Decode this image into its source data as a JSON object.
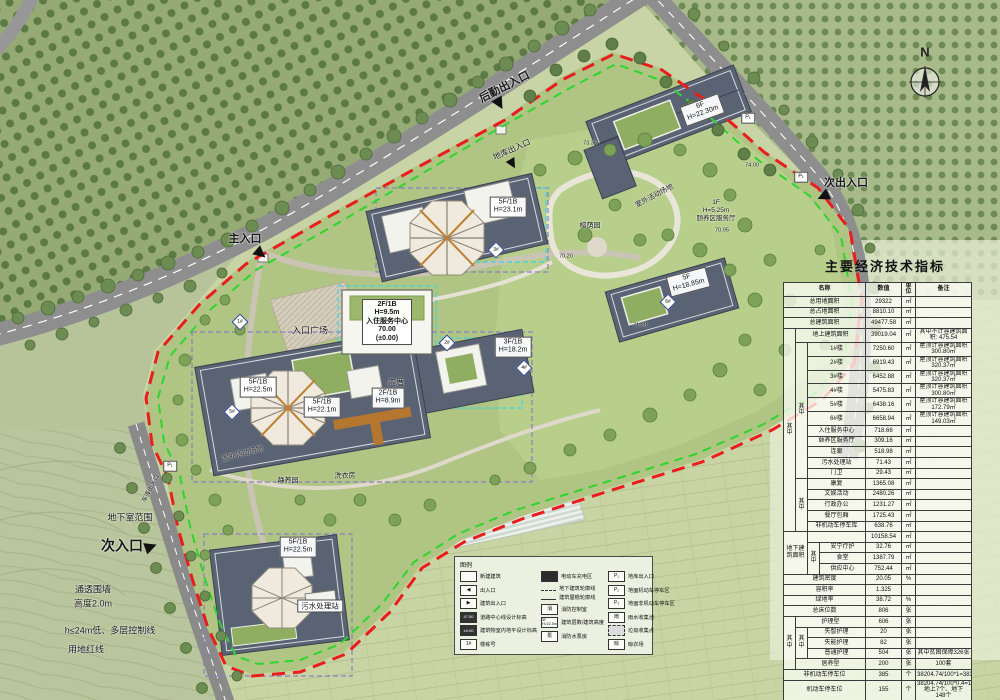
{
  "compass": {
    "label": "N"
  },
  "table": {
    "title": "主要经济技术指标",
    "col_widths": [
      12,
      12,
      12,
      46,
      36,
      14,
      56
    ],
    "rows": [
      [
        {
          "t": "名称",
          "cs": 4,
          "cls": "hd"
        },
        {
          "t": "数值",
          "cls": "hd"
        },
        {
          "t": "单位",
          "cls": "hd"
        },
        {
          "t": "备注",
          "cls": "hd"
        }
      ],
      [
        {
          "t": "总用地面积",
          "cs": 4
        },
        {
          "t": "29322"
        },
        {
          "t": "㎡"
        },
        {
          "t": ""
        }
      ],
      [
        {
          "t": "总占地面积",
          "cs": 4
        },
        {
          "t": "8810.10"
        },
        {
          "t": "㎡"
        },
        {
          "t": ""
        }
      ],
      [
        {
          "t": "总建筑面积",
          "cs": 4
        },
        {
          "t": "49477.58"
        },
        {
          "t": "㎡"
        },
        {
          "t": ""
        }
      ],
      [
        {
          "t": "其中",
          "rs": 17
        },
        {
          "t": "地上建筑面积",
          "cs": 3
        },
        {
          "t": "39019.04"
        },
        {
          "t": "㎡"
        },
        {
          "t": "其中不计容建筑面积: 475.54",
          "cls": "rem"
        }
      ],
      [
        {
          "t": "其中",
          "rs": 11
        },
        {
          "t": "1#楼",
          "cs": 2
        },
        {
          "t": "7250.60"
        },
        {
          "t": "㎡"
        },
        {
          "t": "屋顶计容建筑面积300.80㎡",
          "cls": "rem"
        }
      ],
      [
        {
          "t": "2#楼",
          "cs": 2
        },
        {
          "t": "6919.43"
        },
        {
          "t": "㎡"
        },
        {
          "t": "屋顶计容建筑面积320.37㎡",
          "cls": "rem"
        }
      ],
      [
        {
          "t": "3#楼",
          "cs": 2
        },
        {
          "t": "6452.88"
        },
        {
          "t": "㎡"
        },
        {
          "t": "屋顶计容建筑面积320.37㎡",
          "cls": "rem"
        }
      ],
      [
        {
          "t": "4#楼",
          "cs": 2
        },
        {
          "t": "5475.83"
        },
        {
          "t": "㎡"
        },
        {
          "t": "屋顶计容建筑面积300.80㎡",
          "cls": "rem"
        }
      ],
      [
        {
          "t": "5#楼",
          "cs": 2
        },
        {
          "t": "6438.16"
        },
        {
          "t": "㎡"
        },
        {
          "t": "屋顶计容建筑面积172.79㎡",
          "cls": "rem"
        }
      ],
      [
        {
          "t": "6#楼",
          "cs": 2
        },
        {
          "t": "6658.94"
        },
        {
          "t": "㎡"
        },
        {
          "t": "屋顶计容建筑面积149.03㎡",
          "cls": "rem"
        }
      ],
      [
        {
          "t": "入住服务中心",
          "cs": 2
        },
        {
          "t": "718.66"
        },
        {
          "t": "㎡"
        },
        {
          "t": ""
        }
      ],
      [
        {
          "t": "颐养区服务厅",
          "cs": 2
        },
        {
          "t": "309.16"
        },
        {
          "t": "㎡"
        },
        {
          "t": ""
        }
      ],
      [
        {
          "t": "连廊",
          "cs": 2
        },
        {
          "t": "518.98"
        },
        {
          "t": "㎡"
        },
        {
          "t": ""
        }
      ],
      [
        {
          "t": "污水处理站",
          "cs": 2
        },
        {
          "t": "71.43"
        },
        {
          "t": "㎡"
        },
        {
          "t": ""
        }
      ],
      [
        {
          "t": "门卫",
          "cs": 2
        },
        {
          "t": "29.43"
        },
        {
          "t": "㎡"
        },
        {
          "t": ""
        }
      ],
      [
        {
          "t": "其中",
          "rs": 5
        },
        {
          "t": "康复",
          "cs": 2
        },
        {
          "t": "1365.08"
        },
        {
          "t": "㎡"
        },
        {
          "t": ""
        }
      ],
      [
        {
          "t": "文娱活动",
          "cs": 2
        },
        {
          "t": "2480.26"
        },
        {
          "t": "㎡"
        },
        {
          "t": ""
        }
      ],
      [
        {
          "t": "行政办公",
          "cs": 2
        },
        {
          "t": "1231.27"
        },
        {
          "t": "㎡"
        },
        {
          "t": ""
        }
      ],
      [
        {
          "t": "餐厅包厢",
          "cs": 2
        },
        {
          "t": "1725.43"
        },
        {
          "t": "㎡"
        },
        {
          "t": ""
        }
      ],
      [
        {
          "t": "非机动车停车库",
          "cs": 2
        },
        {
          "t": "638.76"
        },
        {
          "t": "㎡"
        },
        {
          "t": ""
        }
      ],
      [
        {
          "t": "地下建筑面积",
          "cs": 2,
          "rs": 4
        },
        {
          "t": "",
          "cs": 2
        },
        {
          "t": "10158.54"
        },
        {
          "t": "㎡"
        },
        {
          "t": ""
        }
      ],
      [
        {
          "t": "其中",
          "rs": 3
        },
        {
          "t": "安宁疗护"
        },
        {
          "t": "32.76"
        },
        {
          "t": "㎡"
        },
        {
          "t": ""
        }
      ],
      [
        {
          "t": "食堂"
        },
        {
          "t": "1387.79"
        },
        {
          "t": "㎡"
        },
        {
          "t": ""
        }
      ],
      [
        {
          "t": "供应中心"
        },
        {
          "t": "752.44"
        },
        {
          "t": "㎡"
        },
        {
          "t": ""
        }
      ],
      [
        {
          "t": "建筑密度",
          "cs": 4
        },
        {
          "t": "20.05"
        },
        {
          "t": "%"
        },
        {
          "t": ""
        }
      ],
      [
        {
          "t": "容积率",
          "cs": 4
        },
        {
          "t": "1.325"
        },
        {
          "t": ""
        },
        {
          "t": ""
        }
      ],
      [
        {
          "t": "绿地率",
          "cs": 4
        },
        {
          "t": "38.72"
        },
        {
          "t": "%"
        },
        {
          "t": ""
        }
      ],
      [
        {
          "t": "总床位数",
          "cs": 4
        },
        {
          "t": "806"
        },
        {
          "t": "张"
        },
        {
          "t": ""
        }
      ],
      [
        {
          "t": "其中",
          "rs": 5
        },
        {
          "t": "护理型",
          "cs": 3
        },
        {
          "t": "606"
        },
        {
          "t": "张"
        },
        {
          "t": ""
        }
      ],
      [
        {
          "t": "其中",
          "rs": 3
        },
        {
          "t": "失智护理",
          "cs": 2
        },
        {
          "t": "20"
        },
        {
          "t": "张"
        },
        {
          "t": ""
        }
      ],
      [
        {
          "t": "失能护理",
          "cs": 2
        },
        {
          "t": "82"
        },
        {
          "t": "张"
        },
        {
          "t": ""
        }
      ],
      [
        {
          "t": "普通护理",
          "cs": 2
        },
        {
          "t": "504"
        },
        {
          "t": "张"
        },
        {
          "t": "其中贫困保障326张",
          "cls": "rem"
        }
      ],
      [
        {
          "t": "居养型",
          "cs": 3
        },
        {
          "t": "200"
        },
        {
          "t": "张"
        },
        {
          "t": "100套",
          "cls": "rem"
        }
      ],
      [
        {
          "t": "非机动车停车位",
          "cs": 4
        },
        {
          "t": "385"
        },
        {
          "t": "个"
        },
        {
          "t": "38204.74/100*1=383",
          "cls": "rem"
        }
      ],
      [
        {
          "t": "机动车停车位",
          "cs": 4
        },
        {
          "t": "155"
        },
        {
          "t": "个"
        },
        {
          "t": "38204.74/100*0.4=153\n地上7个、地下\n148个",
          "cls": "rem"
        }
      ]
    ]
  },
  "legend": {
    "title": "图例",
    "columns": [
      [
        {
          "icon": "new-building",
          "label": "新建建筑",
          "iconText": ""
        },
        {
          "icon": "entrance",
          "label": "出入口",
          "iconText": "◀"
        },
        {
          "icon": "building-entrance",
          "label": "建筑出入口",
          "iconText": "▶"
        },
        {
          "icon": "road-elevation",
          "label": "道路中心线设计标高",
          "iconText": "47.50"
        },
        {
          "icon": "indoor-elevation",
          "label": "建筑物室内地平设计标高",
          "iconText": "±0.00"
        },
        {
          "icon": "building-number",
          "label": "楼栋号",
          "iconText": "1#"
        }
      ],
      [
        {
          "icon": "ev-charging",
          "label": "电动车充电区",
          "iconText": ""
        },
        {
          "icon": "underground-outline",
          "label": "地下建筑轮廓线",
          "iconText": ""
        },
        {
          "icon": "eave-outline",
          "label": "建筑屋檐轮廓线",
          "iconText": ""
        },
        {
          "icon": "fire-control",
          "label": "消防控制室",
          "iconText": "消"
        },
        {
          "icon": "floors-height",
          "label": "建筑层数/建筑高度",
          "iconText": "5F H=22.5m"
        },
        {
          "icon": "fire-pump",
          "label": "消防水泵房",
          "iconText": "泵"
        }
      ],
      [
        {
          "icon": "garage-entrance",
          "label": "地库出入口",
          "iconText": "P₁"
        },
        {
          "icon": "surface-parking",
          "label": "地面机动车停车区",
          "iconText": "P₂"
        },
        {
          "icon": "non-motor-parking",
          "label": "地面非机动车停车区",
          "iconText": "P₃"
        },
        {
          "icon": "rainwater",
          "label": "雨水收集池",
          "iconText": "雨"
        },
        {
          "icon": "garbage",
          "label": "垃圾收集点",
          "iconText": ""
        },
        {
          "icon": "clothes-drying",
          "label": "晾衣场",
          "iconText": "晾"
        }
      ]
    ]
  },
  "map": {
    "labels": [
      {
        "t": "后勤出入口",
        "x": 505,
        "y": 88,
        "rot": -27,
        "fs": 11,
        "fw": 700
      },
      {
        "t": "地库出入口",
        "x": 512,
        "y": 150,
        "rot": -24,
        "fs": 8
      },
      {
        "t": "次出入口",
        "x": 846,
        "y": 184,
        "fs": 11,
        "fw": 700
      },
      {
        "t": "主入口",
        "x": 245,
        "y": 240,
        "fs": 11,
        "fw": 700
      },
      {
        "t": "次入口",
        "x": 122,
        "y": 546,
        "fs": 14,
        "fw": 700
      },
      {
        "t": "地下室范围",
        "x": 130,
        "y": 518,
        "fs": 9
      },
      {
        "t": "通透围墙",
        "x": 93,
        "y": 590,
        "fs": 9
      },
      {
        "t": "高度2.0m",
        "x": 93,
        "y": 604,
        "fs": 9
      },
      {
        "t": "h≤24m低、多层控制线",
        "x": 110,
        "y": 631,
        "fs": 9
      },
      {
        "t": "用地红线",
        "x": 86,
        "y": 650,
        "fs": 9
      },
      {
        "t": "6F\nH=22.30m",
        "x": 702,
        "y": 110,
        "rot": -20,
        "fs": 7,
        "box": true
      },
      {
        "t": "1F\nH=5.25m\n颐养区服务厅",
        "x": 716,
        "y": 211,
        "fs": 6.5
      },
      {
        "t": "70.95",
        "x": 722,
        "y": 231,
        "fs": 5.5
      },
      {
        "t": "5F\nH=18.85m",
        "x": 688,
        "y": 282,
        "rot": -15,
        "fs": 7,
        "box": true
      },
      {
        "t": "5F/1B\nH=23.1m",
        "x": 508,
        "y": 207,
        "fs": 7,
        "box": true
      },
      {
        "t": "3F/1B\nH=18.2m",
        "x": 513,
        "y": 347,
        "fs": 7,
        "box": true
      },
      {
        "t": "5F/1B\nH=22.1m",
        "x": 322,
        "y": 407,
        "fs": 7,
        "box": true
      },
      {
        "t": "2F/1B\nH=8.9m",
        "x": 388,
        "y": 398,
        "fs": 7,
        "box": true
      },
      {
        "t": "5F/1B\nH=22.5m",
        "x": 258,
        "y": 387,
        "fs": 7,
        "box": true
      },
      {
        "t": "5F/1B\nH=22.5m",
        "x": 298,
        "y": 547,
        "fs": 7,
        "box": true
      },
      {
        "t": "2F/1B\nH=9.5m\n入住服务中心\n70.00\n(±0.00)",
        "x": 387,
        "y": 322,
        "fs": 7,
        "fw": 700,
        "box": true
      },
      {
        "t": "入口广场",
        "x": 310,
        "y": 331,
        "fs": 9
      },
      {
        "t": "内厝",
        "x": 396,
        "y": 383,
        "fs": 8
      },
      {
        "t": "室外活动场地",
        "x": 655,
        "y": 197,
        "rot": -28,
        "fs": 7
      },
      {
        "t": "室外活动场地",
        "x": 243,
        "y": 455,
        "rot": -15,
        "fs": 7
      },
      {
        "t": "榕荫园",
        "x": 590,
        "y": 227,
        "fs": 7
      },
      {
        "t": "静养园",
        "x": 288,
        "y": 482,
        "fs": 7
      },
      {
        "t": "洗衣房",
        "x": 345,
        "y": 477,
        "fs": 7
      },
      {
        "t": "污水处理站",
        "x": 320,
        "y": 606,
        "fs": 7.5,
        "box": true
      },
      {
        "t": "车库出入口",
        "x": 152,
        "y": 489,
        "rot": -62,
        "fs": 6
      },
      {
        "t": "P₁",
        "x": 748,
        "y": 118,
        "fs": 5.5,
        "box": true
      },
      {
        "t": "P₁",
        "x": 801,
        "y": 177,
        "fs": 5.5,
        "box": true
      },
      {
        "t": "P₁",
        "x": 170,
        "y": 466,
        "fs": 5.5,
        "box": true
      },
      {
        "t": "71.20",
        "x": 640,
        "y": 326,
        "fs": 5.5
      },
      {
        "t": "70.20",
        "x": 566,
        "y": 257,
        "fs": 5.5
      },
      {
        "t": "73.35",
        "x": 590,
        "y": 144,
        "fs": 5.5
      },
      {
        "t": "74.00",
        "x": 752,
        "y": 166,
        "fs": 5.5
      }
    ],
    "building_markers": [
      {
        "t": "1#",
        "x": 240,
        "y": 322
      },
      {
        "t": "2#",
        "x": 447,
        "y": 343
      },
      {
        "t": "3#",
        "x": 496,
        "y": 250
      },
      {
        "t": "4#",
        "x": 524,
        "y": 368
      },
      {
        "t": "5#",
        "x": 232,
        "y": 412
      },
      {
        "t": "6#",
        "x": 668,
        "y": 302
      }
    ]
  }
}
